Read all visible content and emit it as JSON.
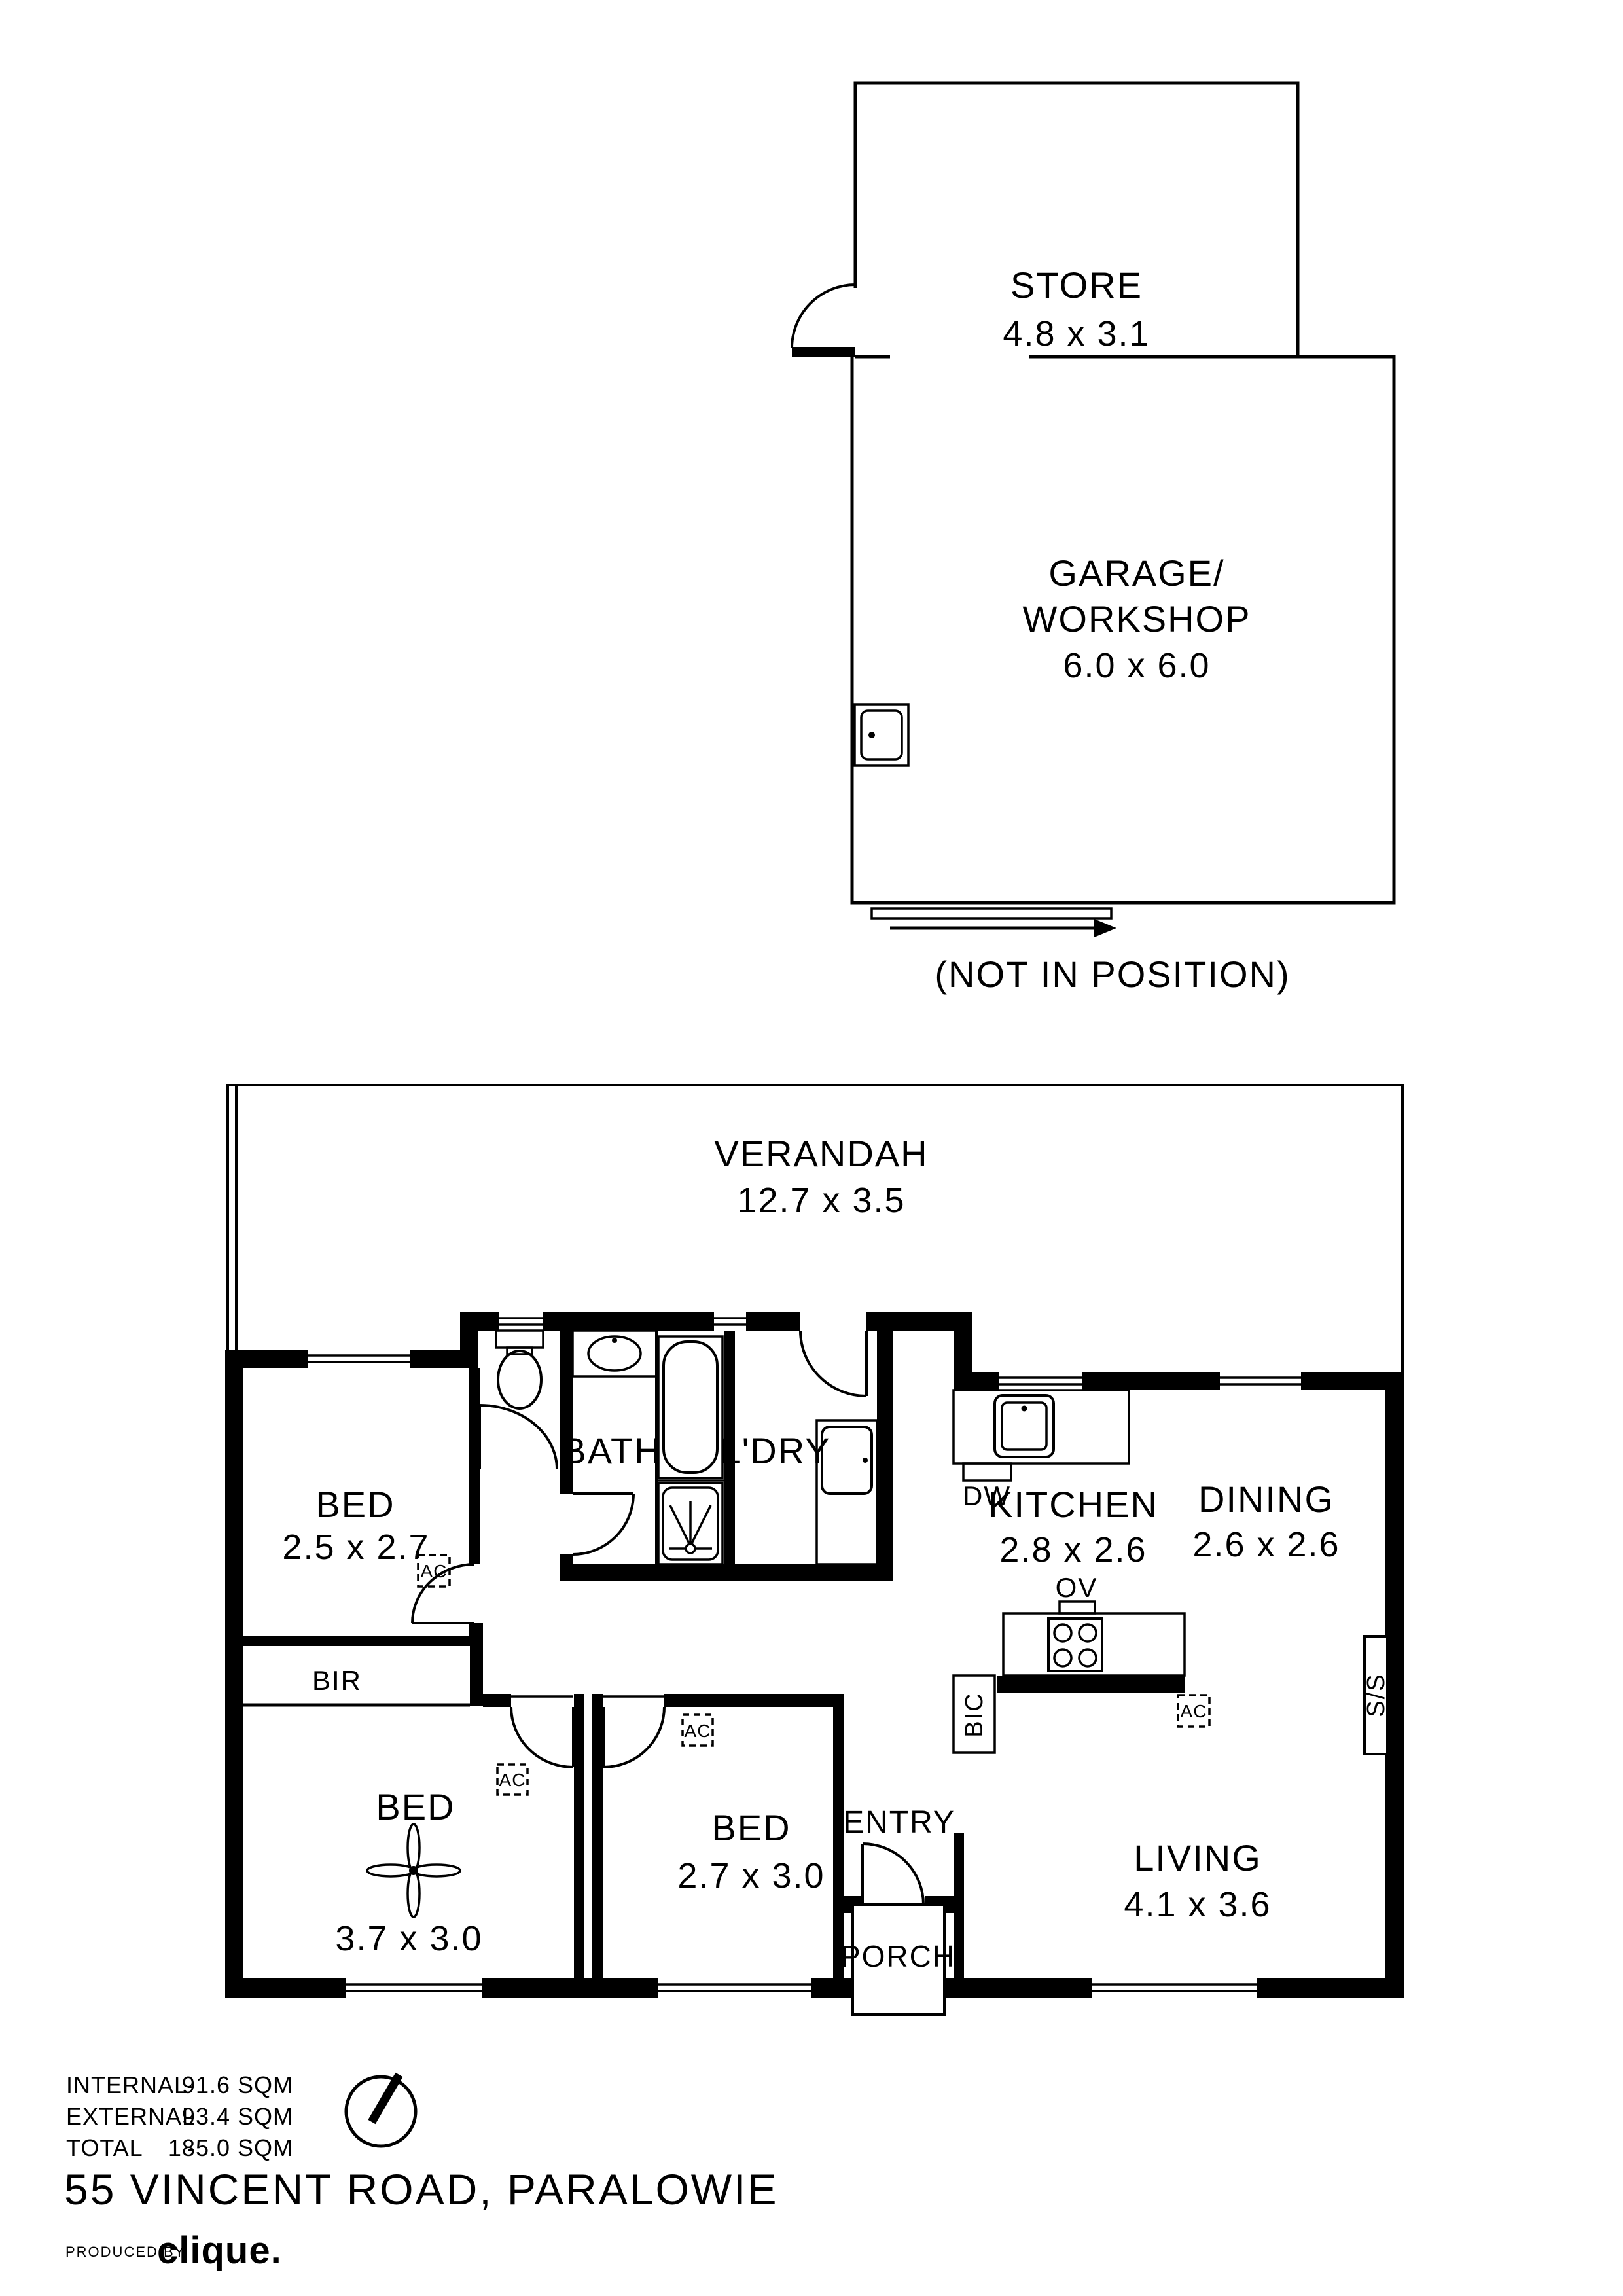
{
  "document": {
    "title": "55 VINCENT ROAD, PARALOWIE",
    "produced_by_label": "PRODUCED BY",
    "brand": "clique."
  },
  "summary": {
    "rows": [
      {
        "label": "INTERNAL",
        "dash": "-",
        "value": "91.6 SQM"
      },
      {
        "label": "EXTERNAL",
        "dash": "-",
        "value": "93.4 SQM"
      },
      {
        "label": "TOTAL",
        "dash": "-",
        "value": "185.0 SQM"
      }
    ]
  },
  "outbuilding": {
    "store_label": "STORE",
    "store_dims": "4.8 x 3.1",
    "garage_label_line1": "GARAGE/",
    "garage_label_line2": "WORKSHOP",
    "garage_dims": "6.0 x 6.0",
    "note": "(NOT IN POSITION)"
  },
  "house": {
    "verandah_label": "VERANDAH",
    "verandah_dims": "12.7 x 3.5",
    "bed1_label": "BED",
    "bed1_dims": "2.5 x 2.7",
    "bath_label": "BATH",
    "ldry_label": "L'DRY",
    "kitchen_label": "KITCHEN",
    "kitchen_dims": "2.8 x 2.6",
    "dining_label": "DINING",
    "dining_dims": "2.6 x 2.6",
    "living_label": "LIVING",
    "living_dims": "4.1 x 3.6",
    "bed2_label": "BED",
    "bed2_dims": "3.7 x 3.0",
    "bed3_label": "BED",
    "bed3_dims": "2.7 x 3.0",
    "entry_label": "ENTRY",
    "porch_label": "PORCH",
    "bir_label": "BIR"
  },
  "fixtures": {
    "dw": "DW",
    "ov": "OV",
    "bic": "BIC",
    "ss": "S/S",
    "ac": "AC"
  },
  "colors": {
    "ink": "#000000",
    "paper": "#ffffff"
  }
}
